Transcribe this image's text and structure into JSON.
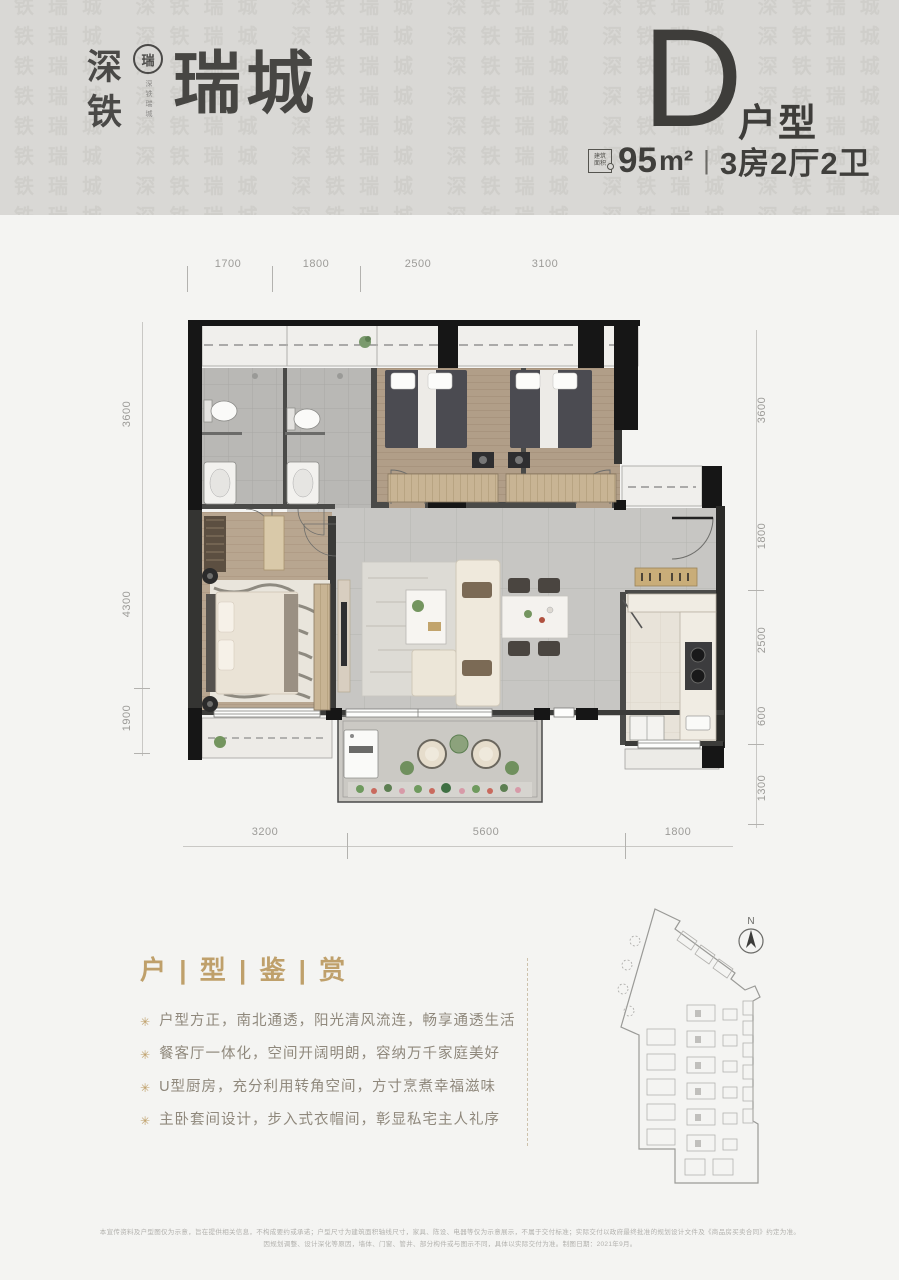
{
  "header": {
    "watermark_text": "深铁瑞城 ",
    "brand_vertical": "深铁",
    "seal_char": "瑞",
    "seal_sub": "深铁瑞城",
    "brand_name": "瑞城",
    "unit_letter": "D",
    "unit_label": "户型",
    "stamp_line1": "建筑",
    "stamp_line2": "面积",
    "area_value": "95",
    "area_unit": "m²",
    "separator": "|",
    "spec": "3房2厅2卫"
  },
  "plan": {
    "dims_top": [
      "1700",
      "1800",
      "2500",
      "3100"
    ],
    "dims_left": [
      "3600",
      "4300",
      "1900"
    ],
    "dims_right": [
      "3600",
      "1800",
      "2500",
      "600",
      "1300"
    ],
    "dims_bottom": [
      "3200",
      "5600",
      "1800"
    ]
  },
  "appreciation": {
    "title": "户 | 型 | 鉴 | 赏",
    "bullet_icon": "✳",
    "bullets": [
      "户型方正，南北通透，阳光清风流连，畅享通透生活",
      "餐客厅一体化，空间开阔明朗，容纳万千家庭美好",
      "U型厨房，充分利用转角空间，方寸烹煮幸福滋味",
      "主卧套间设计，步入式衣帽间，彰显私宅主人礼序"
    ]
  },
  "siteplan": {
    "north_label": "N"
  },
  "disclaimer": {
    "line1": "本宣传资料及户型图仅为示意，旨在提供相关信息，不构成要约或承诺；户型尺寸为建筑面积轴线尺寸，家具、陈设、电器等仅为示意展示，不属于交付标准；实际交付以政府最终批准的规划设计文件及《商品房买卖合同》约定为准。",
    "line2": "因规划调整、设计深化等原因，墙体、门窗、管井、部分构件或与图示不同，具体以实际交付为准。制图日期：2021年9月。"
  },
  "colors": {
    "header_band": "#d9d8d5",
    "page_bg": "#f4f4f2",
    "brand_dark": "#4a4947",
    "gold": "#bfa06b",
    "bullet_text": "#8f887c",
    "dim_text": "#9c9b98",
    "wall_black": "#1a1a1a"
  }
}
